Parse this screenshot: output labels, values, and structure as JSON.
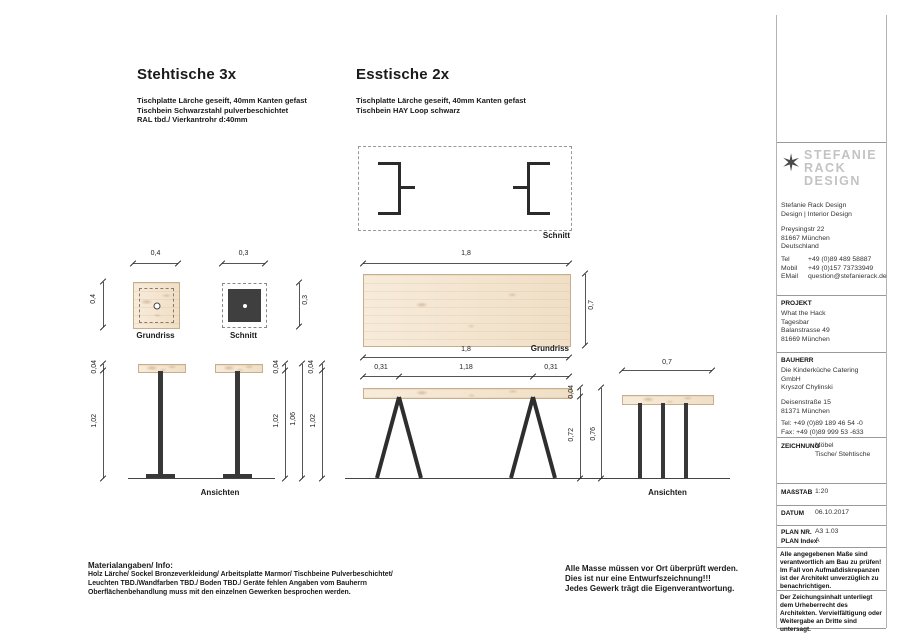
{
  "headers": {
    "left_title": "Stehtische 3x",
    "left_specs": [
      "Tischplatte Lärche geseift, 40mm Kanten gefast",
      "Tischbein Schwarzstahl pulverbeschichtet",
      "RAL tbd./  Vierkantrohr d:40mm"
    ],
    "right_title": "Esstische 2x",
    "right_specs": [
      "Tischplatte Lärche geseift, 40mm Kanten gefast",
      "Tischbein HAY Loop schwarz"
    ]
  },
  "labels": {
    "schnitt_top": "Schnitt",
    "grundriss_stehtisch": "Grundriss",
    "schnitt_stehtisch": "Schnitt",
    "grundriss_esstisch": "Grundriss",
    "ansichten_stehtische": "Ansichten",
    "ansichten_esstisch": "Ansichten"
  },
  "dims": {
    "st_plan_w": "0,4",
    "st_plan_h": "0,4",
    "st_sec_w": "0,3",
    "st_sec_h": "0,3",
    "es_plan_w": "1,8",
    "es_plan_d": "0,7",
    "es_plan_w2": "1,8",
    "es_off_l": "0,31",
    "es_span": "1,18",
    "es_off_r": "0,31",
    "st_el_thk_left": "0,04",
    "st_el_leg_left": "1,02",
    "st_el_thk_1": "0,04",
    "st_el_leg_1": "1,02",
    "st_el_total": "1,06",
    "st_el_thk_2": "0,04",
    "st_el_leg_2": "1,02",
    "es_el_thk": "0,04",
    "es_el_leg": "0,72",
    "es_el_total": "0,76",
    "es_side_w": "0,7"
  },
  "titleblock": {
    "star_icon": "✶",
    "logo_lines": [
      "STEFANIE",
      "RACK",
      "DESIGN"
    ],
    "firm_lines": [
      "Stefanie Rack Design",
      "Design | Interior Design"
    ],
    "address_lines": [
      "Preysingstr 22",
      "81667 München",
      "Deutschland"
    ],
    "contact_rows": [
      {
        "label": "Tel",
        "value": "+49 (0)89 489 58887"
      },
      {
        "label": "Mobil",
        "value": "+49 (0)157 73733949"
      },
      {
        "label": "EMail",
        "value": "question@stefanierack.de"
      }
    ],
    "projekt_label": "PROJEKT",
    "projekt_lines": [
      "What the Hack",
      "Tagesbar",
      "Balanstrasse 49",
      "81669 München"
    ],
    "bauherr_label": "BAUHERR",
    "bauherr_group1": [
      "Die Kinderküche Catering",
      "GmbH",
      "Kryszof Chylinski"
    ],
    "bauherr_group2": [
      "Deisenstraße 15",
      "81371 München"
    ],
    "bauherr_group3": [
      "Tel: +49 (0)89 189 46 54 -0",
      "Fax: +49 (0)89 999 53 -633"
    ],
    "zeichnung_label": "ZEICHNUNG",
    "zeichnung_lines": [
      "Möbel",
      "Tische/ Stehtische"
    ],
    "massstab_label": "MAßSTAB",
    "massstab_value": "1:20",
    "datum_label": "DATUM",
    "datum_value": "06.10.2017",
    "plannr_label": "PLAN NR.",
    "plannr_value": "A3 1.03",
    "planindex_label": "PLAN Index",
    "planindex_value": "A",
    "note1": "Alle angegebenen Maße sind verantwortlich am Bau zu prüfen! Im Fall von Aufmaßdiskrepanzen ist der Architekt unverzüglich zu benachrichtigen.",
    "note2": "Der Zeichungsinhalt unterliegt dem Urheberrecht des Architekten. Vervielfältigung oder Weitergabe an Dritte sind untersagt."
  },
  "footer": {
    "material_title": "Materialangaben/ Info:",
    "material_lines": [
      "Holz Lärche/ Sockel Bronzeverkleidung/ Arbeitsplatte Marmor/ Tischbeine Pulverbeschichtet/",
      "Leuchten TBD./Wandfarben TBD./ Boden TBD./ Geräte fehlen Angaben vom Bauherrn",
      "Oberflächenbehandlung muss mit den einzelnen Gewerken besprochen werden."
    ],
    "notice_lines": [
      "Alle Masse müssen vor Ort überprüft werden.",
      "Dies ist nur eine Entwurfszeichnung!!!",
      "Jedes Gewerk trägt die Eigenverantwortung."
    ]
  },
  "colors": {
    "wood": "#f5e7d3",
    "steel": "#383838",
    "line": "#555555"
  }
}
